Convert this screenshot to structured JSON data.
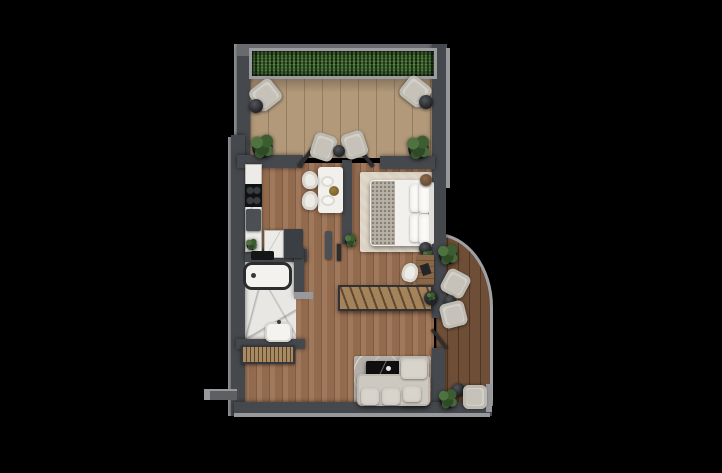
{
  "scene": {
    "type": "apartment-floor-plan-3d-render",
    "background": "#000000",
    "visible_text": []
  },
  "palette": {
    "background": "#000000",
    "wall": "#45484c",
    "wall_top": "#686a6d",
    "wall_outer_light": "#97999c",
    "hedge_green": "#203618",
    "terrace_deck": "#b2997a",
    "interior_wood": "#9b7153",
    "balcony_deck": "#6e4e36",
    "marble": "#e9e7e3",
    "bed_white": "#f1f0ed",
    "sofa_gray": "#cdc9c1",
    "rug_beige": "#dcd3c4",
    "rug_gray": "#b4b0a9",
    "furniture_black": "#141517",
    "furniture_wood": "#a5835a",
    "plant_green": "#3c5c31"
  },
  "items": [
    {
      "n": "terrace-deck-floor",
      "k": "deck",
      "x": 250,
      "y": 76,
      "w": 186,
      "h": 82
    },
    {
      "n": "interior-wood-floor",
      "k": "wood",
      "x": 243,
      "y": 163,
      "w": 191,
      "h": 243
    },
    {
      "n": "balcony-deck-floor",
      "k": "deck-dark",
      "x": 436,
      "y": 233,
      "w": 57,
      "h": 173
    },
    {
      "n": "bathroom-marble-floor",
      "k": "marble-floor",
      "x": 243,
      "y": 259,
      "w": 53,
      "h": 84
    },
    {
      "n": "bedroom-rug",
      "k": "rug-beige",
      "x": 360,
      "y": 172,
      "w": 73,
      "h": 80
    },
    {
      "n": "living-room-rug",
      "k": "rug-gray",
      "x": 354,
      "y": 356,
      "w": 77,
      "h": 52
    },
    {
      "n": "wall-outer-left-light",
      "k": "wall-light",
      "x": 228,
      "y": 137,
      "w": 4,
      "h": 279
    },
    {
      "n": "terrace-outer-left-light",
      "k": "wall-light",
      "x": 234,
      "y": 44,
      "w": 4,
      "h": 100
    },
    {
      "n": "terrace-left-wall",
      "k": "wall",
      "x": 237,
      "y": 44,
      "w": 13,
      "h": 118
    },
    {
      "n": "main-left-wall",
      "k": "wall",
      "x": 231,
      "y": 135,
      "w": 14,
      "h": 281
    },
    {
      "n": "terrace-top-wall",
      "k": "wall-top",
      "x": 237,
      "y": 44,
      "w": 210,
      "h": 12
    },
    {
      "n": "right-wall-upper",
      "k": "wall",
      "x": 432,
      "y": 44,
      "w": 14,
      "h": 274
    },
    {
      "n": "right-outer-light",
      "k": "wall-light",
      "x": 446,
      "y": 48,
      "w": 4,
      "h": 140
    },
    {
      "n": "hedge-frame",
      "k": "hedge-frame",
      "x": 249,
      "y": 48,
      "w": 188,
      "h": 31
    },
    {
      "n": "hedge",
      "k": "hedge",
      "x": 252,
      "y": 51,
      "w": 182,
      "h": 25
    },
    {
      "n": "terrace-bottom-wall-left",
      "k": "wall",
      "x": 237,
      "y": 155,
      "w": 66,
      "h": 13
    },
    {
      "n": "terrace-bottom-wall-right",
      "k": "wall",
      "x": 380,
      "y": 156,
      "w": 55,
      "h": 13
    },
    {
      "n": "dining-bedroom-wall",
      "k": "wall",
      "x": 342,
      "y": 160,
      "w": 10,
      "h": 84
    },
    {
      "n": "bathroom-top-wall",
      "k": "wall",
      "x": 245,
      "y": 249,
      "w": 62,
      "h": 13
    },
    {
      "n": "bathroom-right-wall",
      "k": "wall",
      "x": 294,
      "y": 249,
      "w": 10,
      "h": 48
    },
    {
      "n": "bathroom-door-stub",
      "k": "wall-light",
      "x": 294,
      "y": 292,
      "w": 19,
      "h": 7
    },
    {
      "n": "bathroom-bottom-wall",
      "k": "wall",
      "x": 236,
      "y": 339,
      "w": 69,
      "h": 10
    },
    {
      "n": "right-wall-lower",
      "k": "wall",
      "x": 432,
      "y": 348,
      "w": 13,
      "h": 60
    },
    {
      "n": "bottom-wall",
      "k": "wall",
      "x": 234,
      "y": 402,
      "w": 258,
      "h": 14
    },
    {
      "n": "bottom-outer-light",
      "k": "wall-light",
      "x": 234,
      "y": 413,
      "w": 256,
      "h": 4
    },
    {
      "n": "balcony-bottom-corner-light",
      "k": "wall-light",
      "x": 486,
      "y": 384,
      "w": 6,
      "h": 28
    },
    {
      "n": "entry-stub-outer",
      "k": "wall-light",
      "x": 204,
      "y": 389,
      "w": 33,
      "h": 11
    },
    {
      "n": "entry-stub-inner",
      "k": "wall-mid",
      "x": 210,
      "y": 391,
      "w": 27,
      "h": 9
    },
    {
      "n": "terrace-door-leaf-left",
      "k": "door-leaf",
      "x": 304,
      "y": 146,
      "w": 4,
      "h": 23,
      "r": 38
    },
    {
      "n": "terrace-door-leaf-right",
      "k": "door-leaf",
      "x": 364,
      "y": 146,
      "w": 4,
      "h": 23,
      "r": -38
    },
    {
      "n": "bedroom-door-leaf",
      "k": "door-leaf",
      "x": 337,
      "y": 244,
      "w": 4,
      "h": 17
    },
    {
      "n": "balcony-door-leaf",
      "k": "door-leaf",
      "x": 438,
      "y": 327,
      "w": 3,
      "h": 24,
      "r": -38
    },
    {
      "n": "kitchen-counter",
      "k": "counter-marble",
      "x": 245,
      "y": 164,
      "w": 17,
      "h": 88
    },
    {
      "n": "cooktop",
      "k": "cooktop",
      "x": 245,
      "y": 184,
      "w": 17,
      "h": 23
    },
    {
      "n": "kitchen-sink-unit",
      "k": "unit-dark",
      "x": 246,
      "y": 209,
      "w": 15,
      "h": 22
    },
    {
      "n": "kitchen-counter-2",
      "k": "counter-marble",
      "x": 264,
      "y": 230,
      "w": 20,
      "h": 28
    },
    {
      "n": "kitchen-fridge-unit",
      "k": "unit-darker",
      "x": 284,
      "y": 229,
      "w": 19,
      "h": 29
    },
    {
      "n": "kitchen-counter-plant",
      "k": "plant-s",
      "x": 245,
      "y": 238,
      "w": 13,
      "h": 13
    },
    {
      "n": "bathroom-towel-shelf",
      "k": "unit-black",
      "x": 251,
      "y": 251,
      "w": 23,
      "h": 9
    },
    {
      "n": "dining-table",
      "k": "table-marble",
      "x": 318,
      "y": 167,
      "w": 25,
      "h": 46
    },
    {
      "n": "dining-chair-1",
      "k": "chair-white",
      "x": 302,
      "y": 171,
      "w": 16,
      "h": 18,
      "r": -8
    },
    {
      "n": "dining-chair-2",
      "k": "chair-white",
      "x": 302,
      "y": 191,
      "w": 16,
      "h": 19,
      "r": 6
    },
    {
      "n": "dining-plate-1",
      "k": "plate",
      "x": 321,
      "y": 176,
      "w": 13,
      "h": 11
    },
    {
      "n": "dining-plate-2",
      "k": "plate",
      "x": 321,
      "y": 195,
      "w": 14,
      "h": 11
    },
    {
      "n": "dining-centerpiece",
      "k": "vase",
      "x": 329,
      "y": 186,
      "w": 10,
      "h": 10
    },
    {
      "n": "terrace-armchair-left",
      "k": "armchair",
      "x": 252,
      "y": 82,
      "w": 27,
      "h": 26,
      "r": -38
    },
    {
      "n": "terrace-side-table-left",
      "k": "table-round",
      "x": 249,
      "y": 99,
      "w": 14,
      "h": 14
    },
    {
      "n": "terrace-armchair-right",
      "k": "armchair",
      "x": 402,
      "y": 79,
      "w": 27,
      "h": 25,
      "r": 38
    },
    {
      "n": "terrace-side-table-right",
      "k": "table-round",
      "x": 419,
      "y": 95,
      "w": 14,
      "h": 14
    },
    {
      "n": "terrace-lounge-chair-left",
      "k": "armchair",
      "x": 312,
      "y": 134,
      "w": 23,
      "h": 26,
      "r": 18
    },
    {
      "n": "terrace-lounge-chair-right",
      "k": "armchair",
      "x": 343,
      "y": 132,
      "w": 23,
      "h": 26,
      "r": -18
    },
    {
      "n": "terrace-coffee-table",
      "k": "table-round",
      "x": 333,
      "y": 145,
      "w": 12,
      "h": 12
    },
    {
      "n": "terrace-plant-left",
      "k": "plant",
      "x": 249,
      "y": 133,
      "w": 27,
      "h": 27
    },
    {
      "n": "terrace-plant-right",
      "k": "plant",
      "x": 405,
      "y": 134,
      "w": 27,
      "h": 27
    },
    {
      "n": "bed",
      "k": "bed-base",
      "x": 370,
      "y": 180,
      "w": 58,
      "h": 66
    },
    {
      "n": "bed-throw",
      "k": "bed-throw",
      "x": 371,
      "y": 181,
      "w": 24,
      "h": 64
    },
    {
      "n": "bed-pillow-1",
      "k": "pillow",
      "x": 410,
      "y": 184,
      "w": 10,
      "h": 28
    },
    {
      "n": "bed-pillow-2",
      "k": "pillow",
      "x": 410,
      "y": 214,
      "w": 10,
      "h": 28
    },
    {
      "n": "bed-pillow-3",
      "k": "pillow",
      "x": 419,
      "y": 183,
      "w": 11,
      "h": 30
    },
    {
      "n": "bed-pillow-4",
      "k": "pillow",
      "x": 419,
      "y": 214,
      "w": 11,
      "h": 30
    },
    {
      "n": "bed-headboard",
      "k": "headboard",
      "x": 429,
      "y": 182,
      "w": 5,
      "h": 62
    },
    {
      "n": "bedroom-planter",
      "k": "pot-brown",
      "x": 420,
      "y": 174,
      "w": 12,
      "h": 12
    },
    {
      "n": "bedroom-stool",
      "k": "table-round",
      "x": 419,
      "y": 242,
      "w": 13,
      "h": 13
    },
    {
      "n": "bedroom-stool-plant",
      "k": "plant-s",
      "x": 422,
      "y": 250,
      "w": 11,
      "h": 11
    },
    {
      "n": "bedroom-desk",
      "k": "desk",
      "x": 417,
      "y": 255,
      "w": 17,
      "h": 30
    },
    {
      "n": "desk-chair",
      "k": "chair-white",
      "x": 402,
      "y": 263,
      "w": 16,
      "h": 19,
      "r": 14
    },
    {
      "n": "hallway-plant",
      "k": "plant-s",
      "x": 344,
      "y": 233,
      "w": 13,
      "h": 15
    },
    {
      "n": "hallway-console",
      "k": "console",
      "x": 338,
      "y": 285,
      "w": 95,
      "h": 26
    },
    {
      "n": "console-planter",
      "k": "table-round",
      "x": 424,
      "y": 291,
      "w": 14,
      "h": 14
    },
    {
      "n": "console-planter-leaves",
      "k": "plant-s",
      "x": 426,
      "y": 292,
      "w": 10,
      "h": 9
    },
    {
      "n": "hallway-mirror",
      "k": "unit-dark",
      "x": 325,
      "y": 231,
      "w": 7,
      "h": 28
    },
    {
      "n": "hallway-bench",
      "k": "bench",
      "x": 241,
      "y": 345,
      "w": 54,
      "h": 19
    },
    {
      "n": "bathtub",
      "k": "tub",
      "x": 243,
      "y": 262,
      "w": 49,
      "h": 28
    },
    {
      "n": "bathroom-sink",
      "k": "sink",
      "x": 265,
      "y": 322,
      "w": 27,
      "h": 20
    },
    {
      "n": "coffee-table",
      "k": "table-black",
      "x": 366,
      "y": 361,
      "w": 36,
      "h": 17
    },
    {
      "n": "sofa-chaise",
      "k": "sofa",
      "x": 399,
      "y": 356,
      "w": 30,
      "h": 50
    },
    {
      "n": "sofa-base",
      "k": "sofa",
      "x": 357,
      "y": 374,
      "w": 73,
      "h": 32
    },
    {
      "n": "sofa-cushion-1",
      "k": "sofa-cushion",
      "x": 361,
      "y": 388,
      "w": 18,
      "h": 17
    },
    {
      "n": "sofa-cushion-2",
      "k": "sofa-cushion",
      "x": 382,
      "y": 388,
      "w": 18,
      "h": 17
    },
    {
      "n": "sofa-cushion-3",
      "k": "sofa-cushion",
      "x": 403,
      "y": 386,
      "w": 18,
      "h": 16
    },
    {
      "n": "sofa-chaise-pillow",
      "k": "sofa-cushion",
      "x": 401,
      "y": 359,
      "w": 26,
      "h": 20
    },
    {
      "n": "balcony-plant-top",
      "k": "plant",
      "x": 436,
      "y": 243,
      "w": 24,
      "h": 23
    },
    {
      "n": "balcony-armchair-1",
      "k": "armchair",
      "x": 443,
      "y": 271,
      "w": 25,
      "h": 25,
      "r": 28
    },
    {
      "n": "balcony-side-table",
      "k": "table-round",
      "x": 444,
      "y": 295,
      "w": 12,
      "h": 12
    },
    {
      "n": "balcony-armchair-2",
      "k": "armchair",
      "x": 441,
      "y": 302,
      "w": 25,
      "h": 25,
      "r": -14
    },
    {
      "n": "balcony-side-table-2",
      "k": "table-round",
      "x": 451,
      "y": 383,
      "w": 14,
      "h": 14
    },
    {
      "n": "balcony-armchair-3",
      "k": "armchair",
      "x": 463,
      "y": 385,
      "w": 24,
      "h": 24,
      "r": 90
    },
    {
      "n": "balcony-plant-bottom",
      "k": "plant",
      "x": 437,
      "y": 388,
      "w": 22,
      "h": 22
    }
  ]
}
